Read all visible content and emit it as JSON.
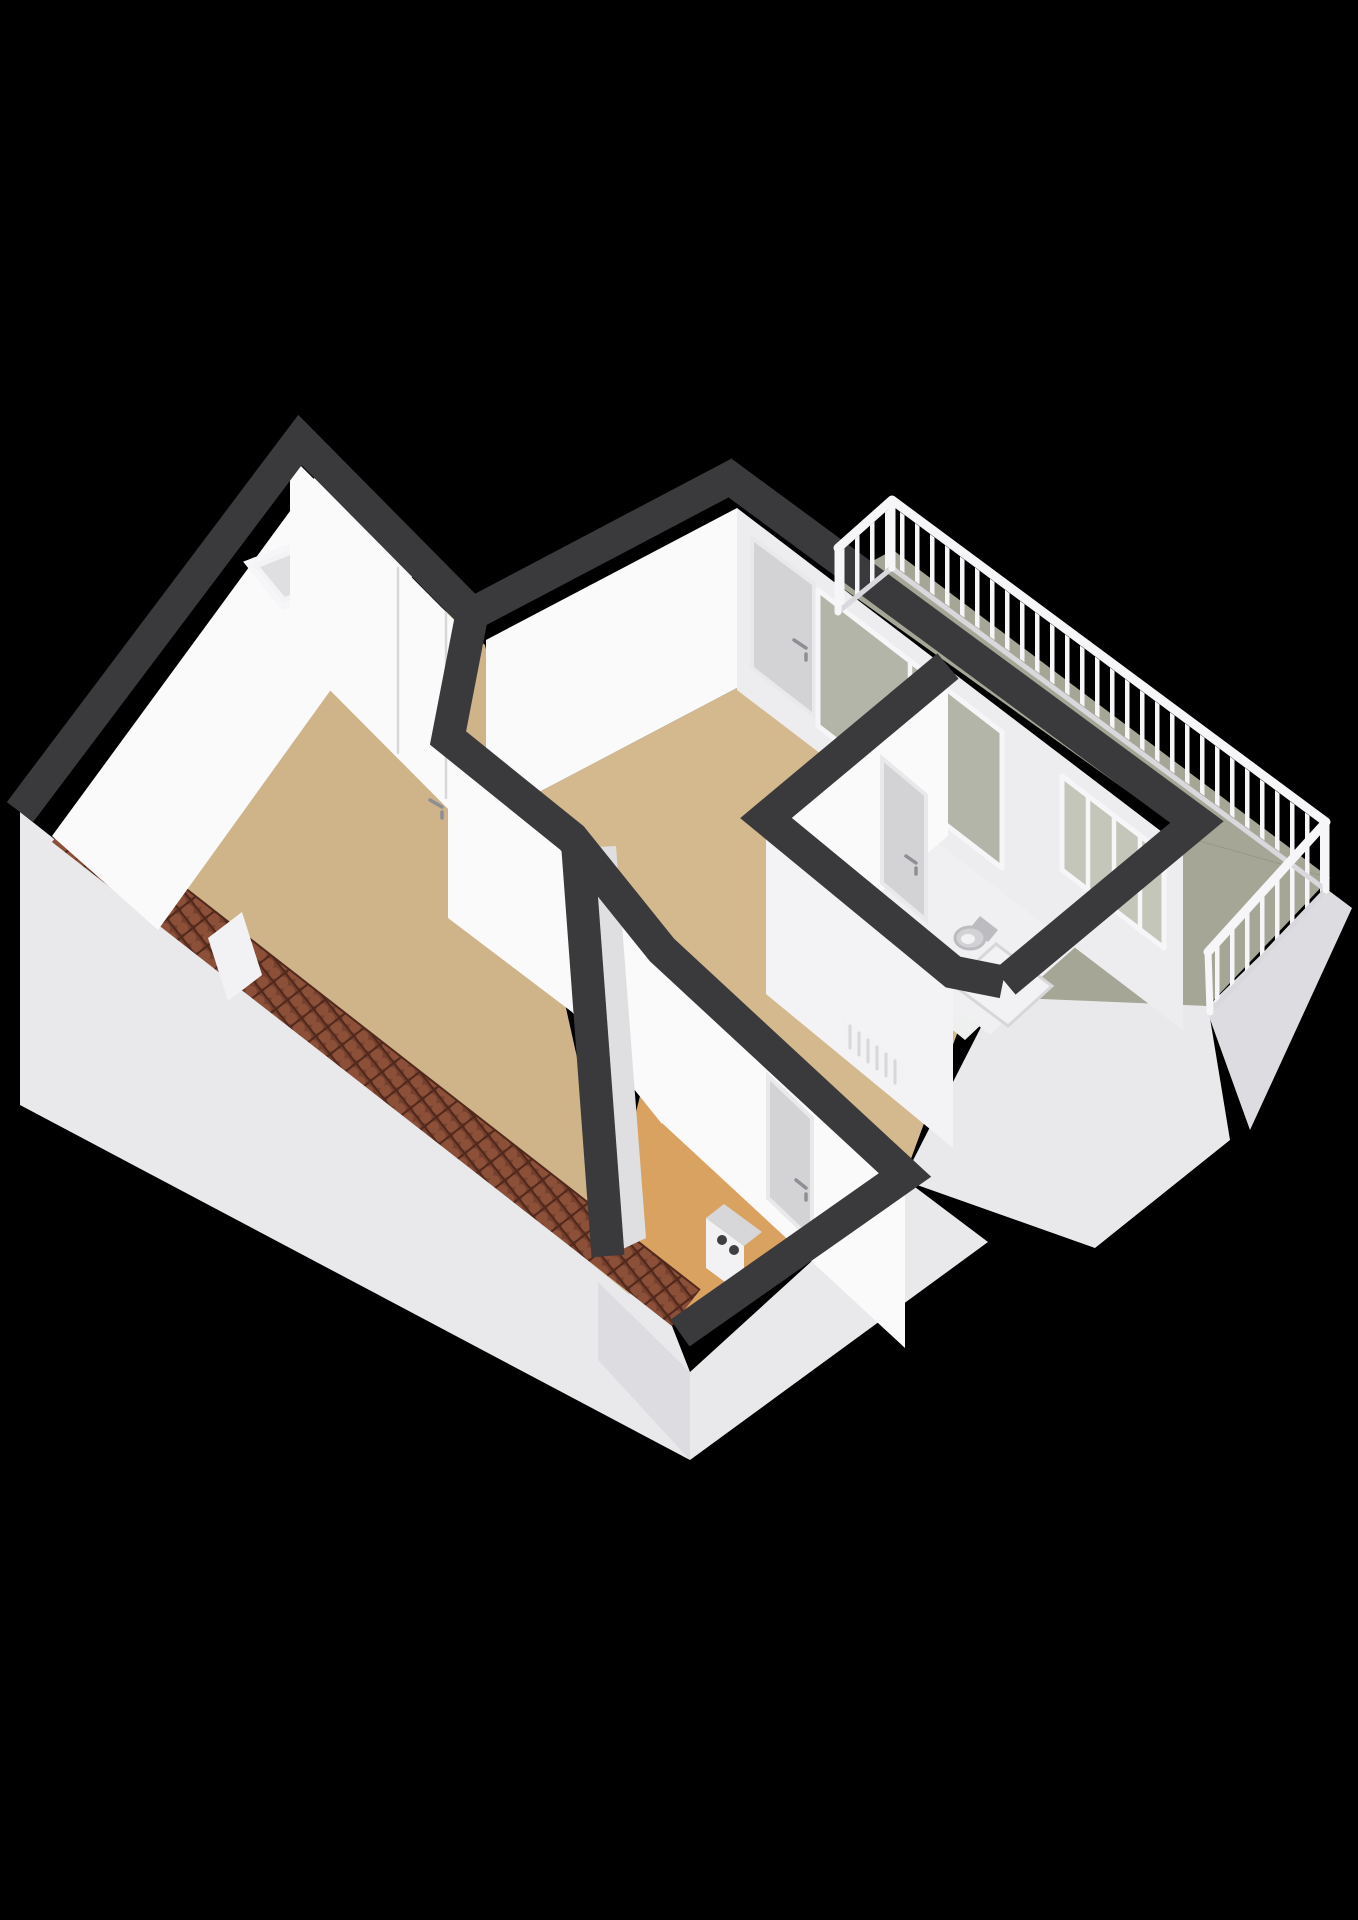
{
  "title": "3D floor plan render",
  "scene": {
    "type": "axonometric-3d-floor-plan",
    "background": "black",
    "rooms": [
      {
        "id": "attic-room",
        "floor": "wood",
        "features": [
          "skylight",
          "sloped-walls",
          "roof-tile-edge"
        ]
      },
      {
        "id": "main-room",
        "floor": "wood",
        "features": [
          "balcony-door",
          "sliding-glass-door",
          "interior-door"
        ]
      },
      {
        "id": "lower-room",
        "floor": "wood-orange",
        "features": [
          "interior-door",
          "boiler",
          "roof-tile-edge"
        ]
      },
      {
        "id": "hallway",
        "floor": "white",
        "features": [
          "radiator"
        ]
      },
      {
        "id": "bathroom",
        "floor": "white",
        "features": [
          "toilet",
          "shower-tray",
          "door",
          "windows"
        ]
      },
      {
        "id": "balcony",
        "floor": "concrete-green",
        "features": [
          "railing",
          "l-shape"
        ]
      }
    ],
    "fixtures": [
      "skylight-window",
      "balcony-door",
      "sliding-glass-door",
      "bathroom-windows",
      "toilet",
      "shower-tray",
      "radiator",
      "boiler-unit",
      "roof-tiles",
      "balustrade-railing"
    ]
  },
  "railing": {
    "baluster_spacing_px": 15,
    "segments": [
      "northwest-return",
      "northeast-long",
      "southeast-wing"
    ]
  },
  "colors": {
    "background": "#000000",
    "wall_top_band": "#3a3a3c",
    "face_lit": "#fafafb",
    "face_lit2": "#f3f3f5",
    "face_med": "#ededef",
    "face_shade": "#dfdfe2",
    "exterior": "#e9e9ec",
    "exterior_shade": "#dddde1",
    "floor_wood": "#d5b98e",
    "floor_wood_left": "#cfb389",
    "floor_orange": "#d9a261",
    "floor_bath": "#f0f0f2",
    "floor_hall": "#eef0f0",
    "floor_balcony": "#a6a697",
    "glass": "#b2b5a7",
    "glass_light": "#c3c6b8",
    "tiles_base": "#743f2d",
    "tiles_light": "#8c5038",
    "tiles_dark": "#50281c",
    "railing": "#f6f6f8",
    "railing_shade": "#d9d9dd",
    "door_panel": "#d3d3d6",
    "door_frame": "#e9e9ec",
    "seam": "#d8d8db",
    "fixture": "#f2f2f4",
    "fixture_shade": "#d7d7da",
    "handle": "#8e8e94",
    "boiler_dot": "#3f3f42",
    "toilet": "#d2d2d5",
    "toilet_ring": "#bcbcc0"
  }
}
